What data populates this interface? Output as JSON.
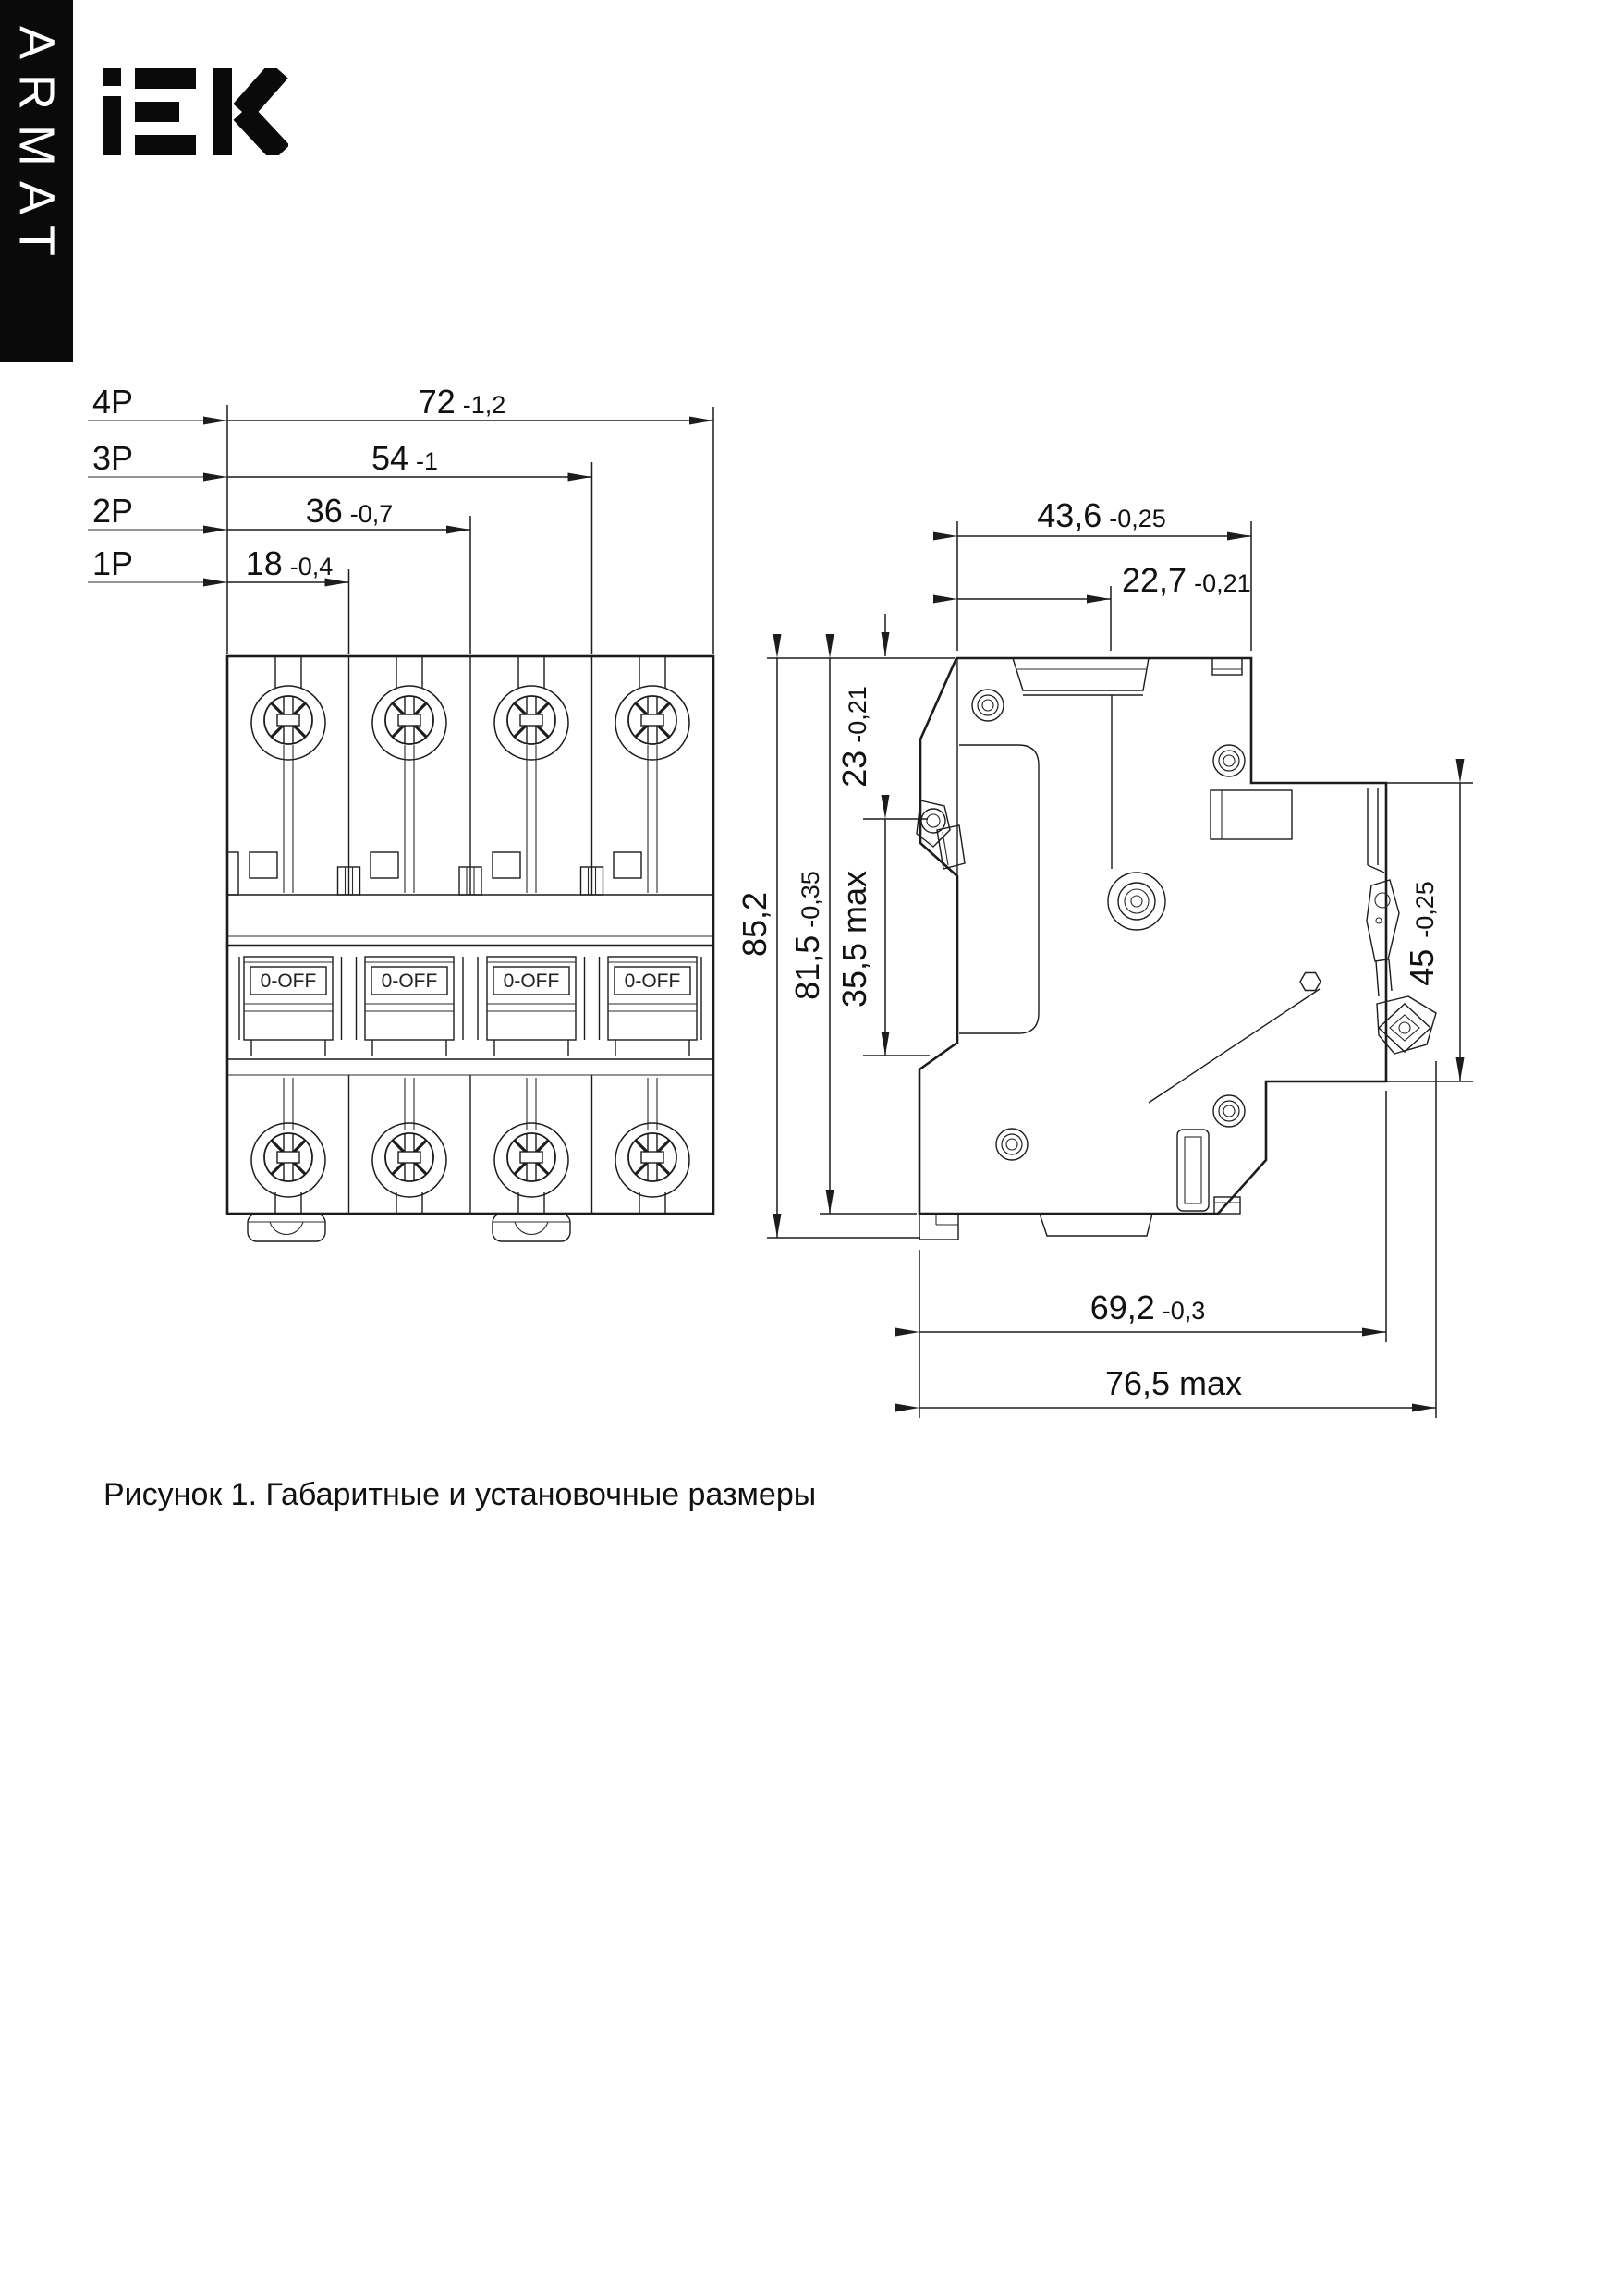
{
  "header": {
    "series_vertical": "ARMAT",
    "logo": "iEK"
  },
  "figure_caption": "Рисунок 1. Габаритные и установочные размеры",
  "front_view": {
    "rows": {
      "p4": {
        "label": "4P",
        "value": "72",
        "tol": "-1,2"
      },
      "p3": {
        "label": "3P",
        "value": "54",
        "tol": "-1"
      },
      "p2": {
        "label": "2P",
        "value": "36",
        "tol": "-0,7"
      },
      "p1": {
        "label": "1P",
        "value": "18",
        "tol": "-0,4"
      }
    },
    "toggle_labels": [
      "0-OFF",
      "0-OFF",
      "0-OFF",
      "0-OFF"
    ]
  },
  "side_view": {
    "dims": {
      "width_top": {
        "value": "43,6",
        "tol": "-0,25"
      },
      "width_inner": {
        "value": "22,7",
        "tol": "-0,21"
      },
      "height_overall": {
        "value": "85,2",
        "tol": ""
      },
      "height_body": {
        "value": "81,5",
        "tol": "-0,35"
      },
      "top_to_screw": {
        "value": "23",
        "tol": "-0,21"
      },
      "screw_to_clip": {
        "value": "35,5 max",
        "tol": ""
      },
      "din_recess": {
        "value": "45",
        "tol": "-0,25"
      },
      "depth": {
        "value": "69,2",
        "tol": "-0,3"
      },
      "depth_max": {
        "value": "76,5 max",
        "tol": ""
      }
    }
  }
}
